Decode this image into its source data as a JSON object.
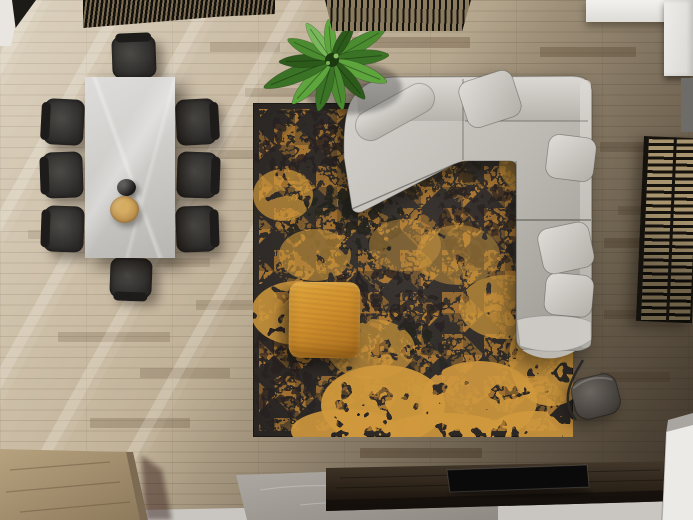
{
  "meta": {
    "title": "Top-down render of a modern living and dining room",
    "description": "Bird's-eye 3D render: white marble dining table with eight dark chairs, a teapot and wooden bowl on top; charcoal rug with distressed amber triangle pattern; light grey L-shaped sectional sofa with four cushions and a throw; mustard fabric ottoman; potted banana plant; dark slatted ceiling screens; slatted side screen; grey drum floor lamp; dark wood media console with flat TV on a concrete plinth; oak plank flooring with diagonal window light."
  },
  "palette": {
    "wood_base": "#b3a48e",
    "wood_dark": "#6e5a42",
    "chair_dark": "#2c2a28",
    "chair_mid": "#4c4a47",
    "rug_base": "#38332f",
    "rug_base2": "#262220",
    "rug_accent": "#c08434",
    "rug_accent_bright": "#d0993d",
    "sofa_light": "#d3d0cb",
    "sofa_mid": "#bdbab4",
    "sofa_dark": "#9b9892",
    "sofa_seam": "rgba(62,60,56,0.4)",
    "pillow_light": "#e0ddd8",
    "ottoman": "#cf8f2d",
    "ottoman_dark": "#a96d1d",
    "lamp_shade": "#6b6660",
    "lamp_shade_dark": "#393531",
    "console_top": "#3a2f23",
    "console_front": "#140f0a",
    "tv_black": "#0a0a0b",
    "slab": "#a5a09a",
    "floor_strip": "#c9c6c1",
    "white_wall": "#eceae6",
    "blind_frame": "#15120e",
    "blind_gap": "#a8956f",
    "block_top": "#ac9774",
    "block_side": "#7c6a52"
  },
  "floor": {
    "plank_accents": [
      [
        352,
        37,
        118,
        11,
        0.45
      ],
      [
        540,
        47,
        96,
        10,
        0.4
      ],
      [
        245,
        88,
        80,
        9,
        0.3
      ],
      [
        600,
        142,
        64,
        10,
        0.35
      ],
      [
        604,
        238,
        89,
        10,
        0.4
      ],
      [
        360,
        448,
        122,
        10,
        0.5
      ],
      [
        196,
        300,
        92,
        10,
        0.28
      ],
      [
        58,
        332,
        112,
        10,
        0.3
      ],
      [
        210,
        150,
        70,
        9,
        0.3
      ],
      [
        618,
        206,
        75,
        9,
        0.3
      ],
      [
        90,
        418,
        100,
        10,
        0.32
      ],
      [
        140,
        368,
        90,
        10,
        0.3
      ],
      [
        600,
        372,
        70,
        10,
        0.28
      ],
      [
        210,
        42,
        70,
        10,
        0.3
      ],
      [
        46,
        120,
        60,
        9,
        0.25
      ],
      [
        604,
        310,
        60,
        9,
        0.3
      ],
      [
        28,
        230,
        66,
        9,
        0.25
      ],
      [
        150,
        258,
        60,
        9,
        0.22
      ]
    ]
  },
  "dining": {
    "seats": 8,
    "chairs": [
      {
        "x": 112,
        "y": 36,
        "w": 44,
        "h": 42,
        "rot": -2,
        "back": "top"
      },
      {
        "x": 110,
        "y": 258,
        "w": 42,
        "h": 40,
        "rot": 2,
        "back": "bottom"
      },
      {
        "x": 44,
        "y": 99,
        "w": 40,
        "h": 46,
        "rot": 3,
        "back": "left"
      },
      {
        "x": 43,
        "y": 152,
        "w": 40,
        "h": 46,
        "rot": -2,
        "back": "left"
      },
      {
        "x": 44,
        "y": 206,
        "w": 40,
        "h": 46,
        "rot": 2,
        "back": "left"
      },
      {
        "x": 176,
        "y": 99,
        "w": 40,
        "h": 46,
        "rot": -3,
        "back": "right"
      },
      {
        "x": 177,
        "y": 152,
        "w": 40,
        "h": 46,
        "rot": 2,
        "back": "right"
      },
      {
        "x": 176,
        "y": 206,
        "w": 40,
        "h": 46,
        "rot": -2,
        "back": "right"
      }
    ]
  },
  "rug": {
    "x": 253,
    "y": 103,
    "w": 320,
    "h": 334,
    "accent_blotches": [
      [
        44,
        210,
        46,
        32,
        0.85
      ],
      [
        130,
        302,
        62,
        40,
        0.95
      ],
      [
        226,
        298,
        58,
        40,
        0.9
      ],
      [
        298,
        255,
        42,
        48,
        0.85
      ],
      [
        282,
        62,
        36,
        30,
        0.6
      ],
      [
        30,
        92,
        30,
        26,
        0.7
      ],
      [
        205,
        152,
        42,
        30,
        0.5
      ],
      [
        302,
        132,
        30,
        44,
        0.65
      ],
      [
        92,
        328,
        54,
        22,
        0.9
      ],
      [
        192,
        330,
        62,
        20,
        0.9
      ],
      [
        282,
        330,
        48,
        22,
        0.9
      ],
      [
        152,
        142,
        36,
        26,
        0.45
      ],
      [
        252,
        204,
        46,
        32,
        0.7
      ],
      [
        62,
        152,
        36,
        26,
        0.6
      ],
      [
        118,
        246,
        44,
        30,
        0.7
      ],
      [
        318,
        180,
        24,
        60,
        0.7
      ]
    ],
    "dark_blotches": [
      [
        92,
        122,
        62,
        42,
        0.9
      ],
      [
        42,
        42,
        52,
        36,
        0.8
      ],
      [
        172,
        62,
        56,
        36,
        0.7
      ],
      [
        122,
        212,
        72,
        46,
        0.8
      ],
      [
        232,
        122,
        52,
        42,
        0.6
      ],
      [
        62,
        302,
        56,
        36,
        0.5
      ],
      [
        20,
        260,
        40,
        60,
        0.6
      ],
      [
        150,
        250,
        50,
        30,
        0.5
      ]
    ]
  },
  "sofa": {
    "pillow_count": 4,
    "pillows": [
      [
        490,
        99,
        56,
        48,
        -18
      ],
      [
        571,
        158,
        48,
        44,
        7
      ],
      [
        569,
        295,
        48,
        42,
        5
      ],
      [
        566,
        248,
        52,
        46,
        -12
      ]
    ]
  },
  "plant": {
    "cx": 332,
    "cy": 60,
    "colors": [
      "#1e3f0e",
      "#2c5a1b",
      "#3a7326",
      "#4c8c31",
      "#5ea53e",
      "#79b85a"
    ],
    "leaves": [
      [
        -30,
        60,
        3,
        1
      ],
      [
        -5,
        56,
        2,
        1
      ],
      [
        22,
        58,
        4,
        1
      ],
      [
        50,
        50,
        1,
        0.9
      ],
      [
        78,
        50,
        3,
        0.9
      ],
      [
        105,
        52,
        2,
        1
      ],
      [
        132,
        58,
        4,
        1
      ],
      [
        158,
        72,
        2,
        1.1
      ],
      [
        178,
        52,
        1,
        0.9
      ],
      [
        -155,
        48,
        3,
        0.9
      ],
      [
        -125,
        44,
        5,
        0.8
      ],
      [
        -95,
        40,
        4,
        0.8
      ],
      [
        -60,
        42,
        1,
        0.8
      ]
    ]
  }
}
